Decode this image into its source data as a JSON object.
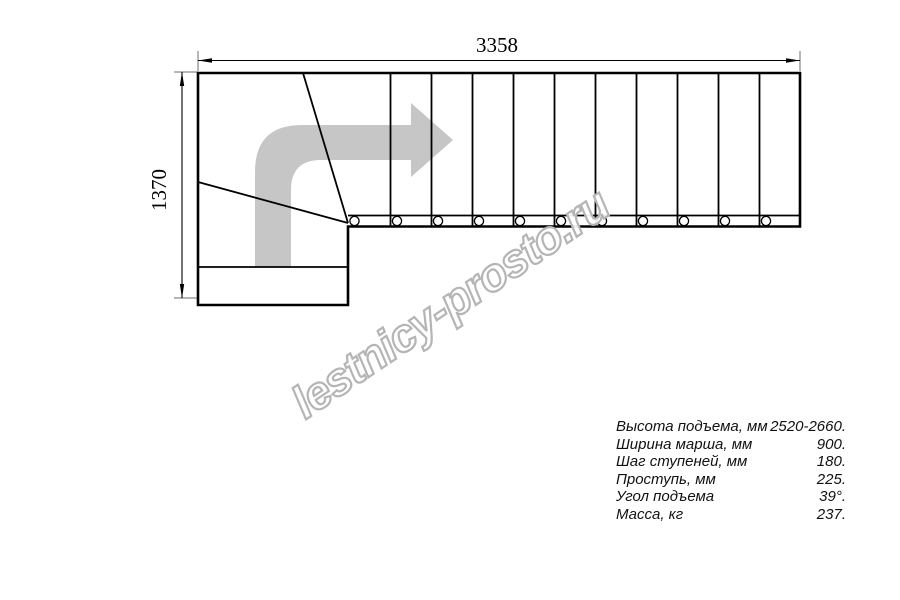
{
  "watermark": {
    "text": "lestnicy-prosto.ru"
  },
  "dimensions": {
    "width_label": "3358",
    "height_label": "1370"
  },
  "specs": {
    "rows": [
      {
        "label": "Высота подъема, мм",
        "value": "2520-2660."
      },
      {
        "label": "Ширина марша, мм",
        "value": "900."
      },
      {
        "label": "Шаг ступеней, мм",
        "value": "180."
      },
      {
        "label": "Проступь, мм",
        "value": "225."
      },
      {
        "label": "Угол подъема",
        "value": "39°."
      },
      {
        "label": "Масса, кг",
        "value": "237."
      }
    ]
  },
  "drawing": {
    "type": "staircase-plan-top-view",
    "direction_arrow": "up-then-right-turn",
    "straight_step_lines": 10,
    "winder_lines": 2,
    "baluster_count": 11,
    "colors": {
      "line": "#000000",
      "arrow_fill": "#c6c6c6",
      "watermark_outline": "#b5b5b5",
      "background": "#ffffff"
    }
  }
}
